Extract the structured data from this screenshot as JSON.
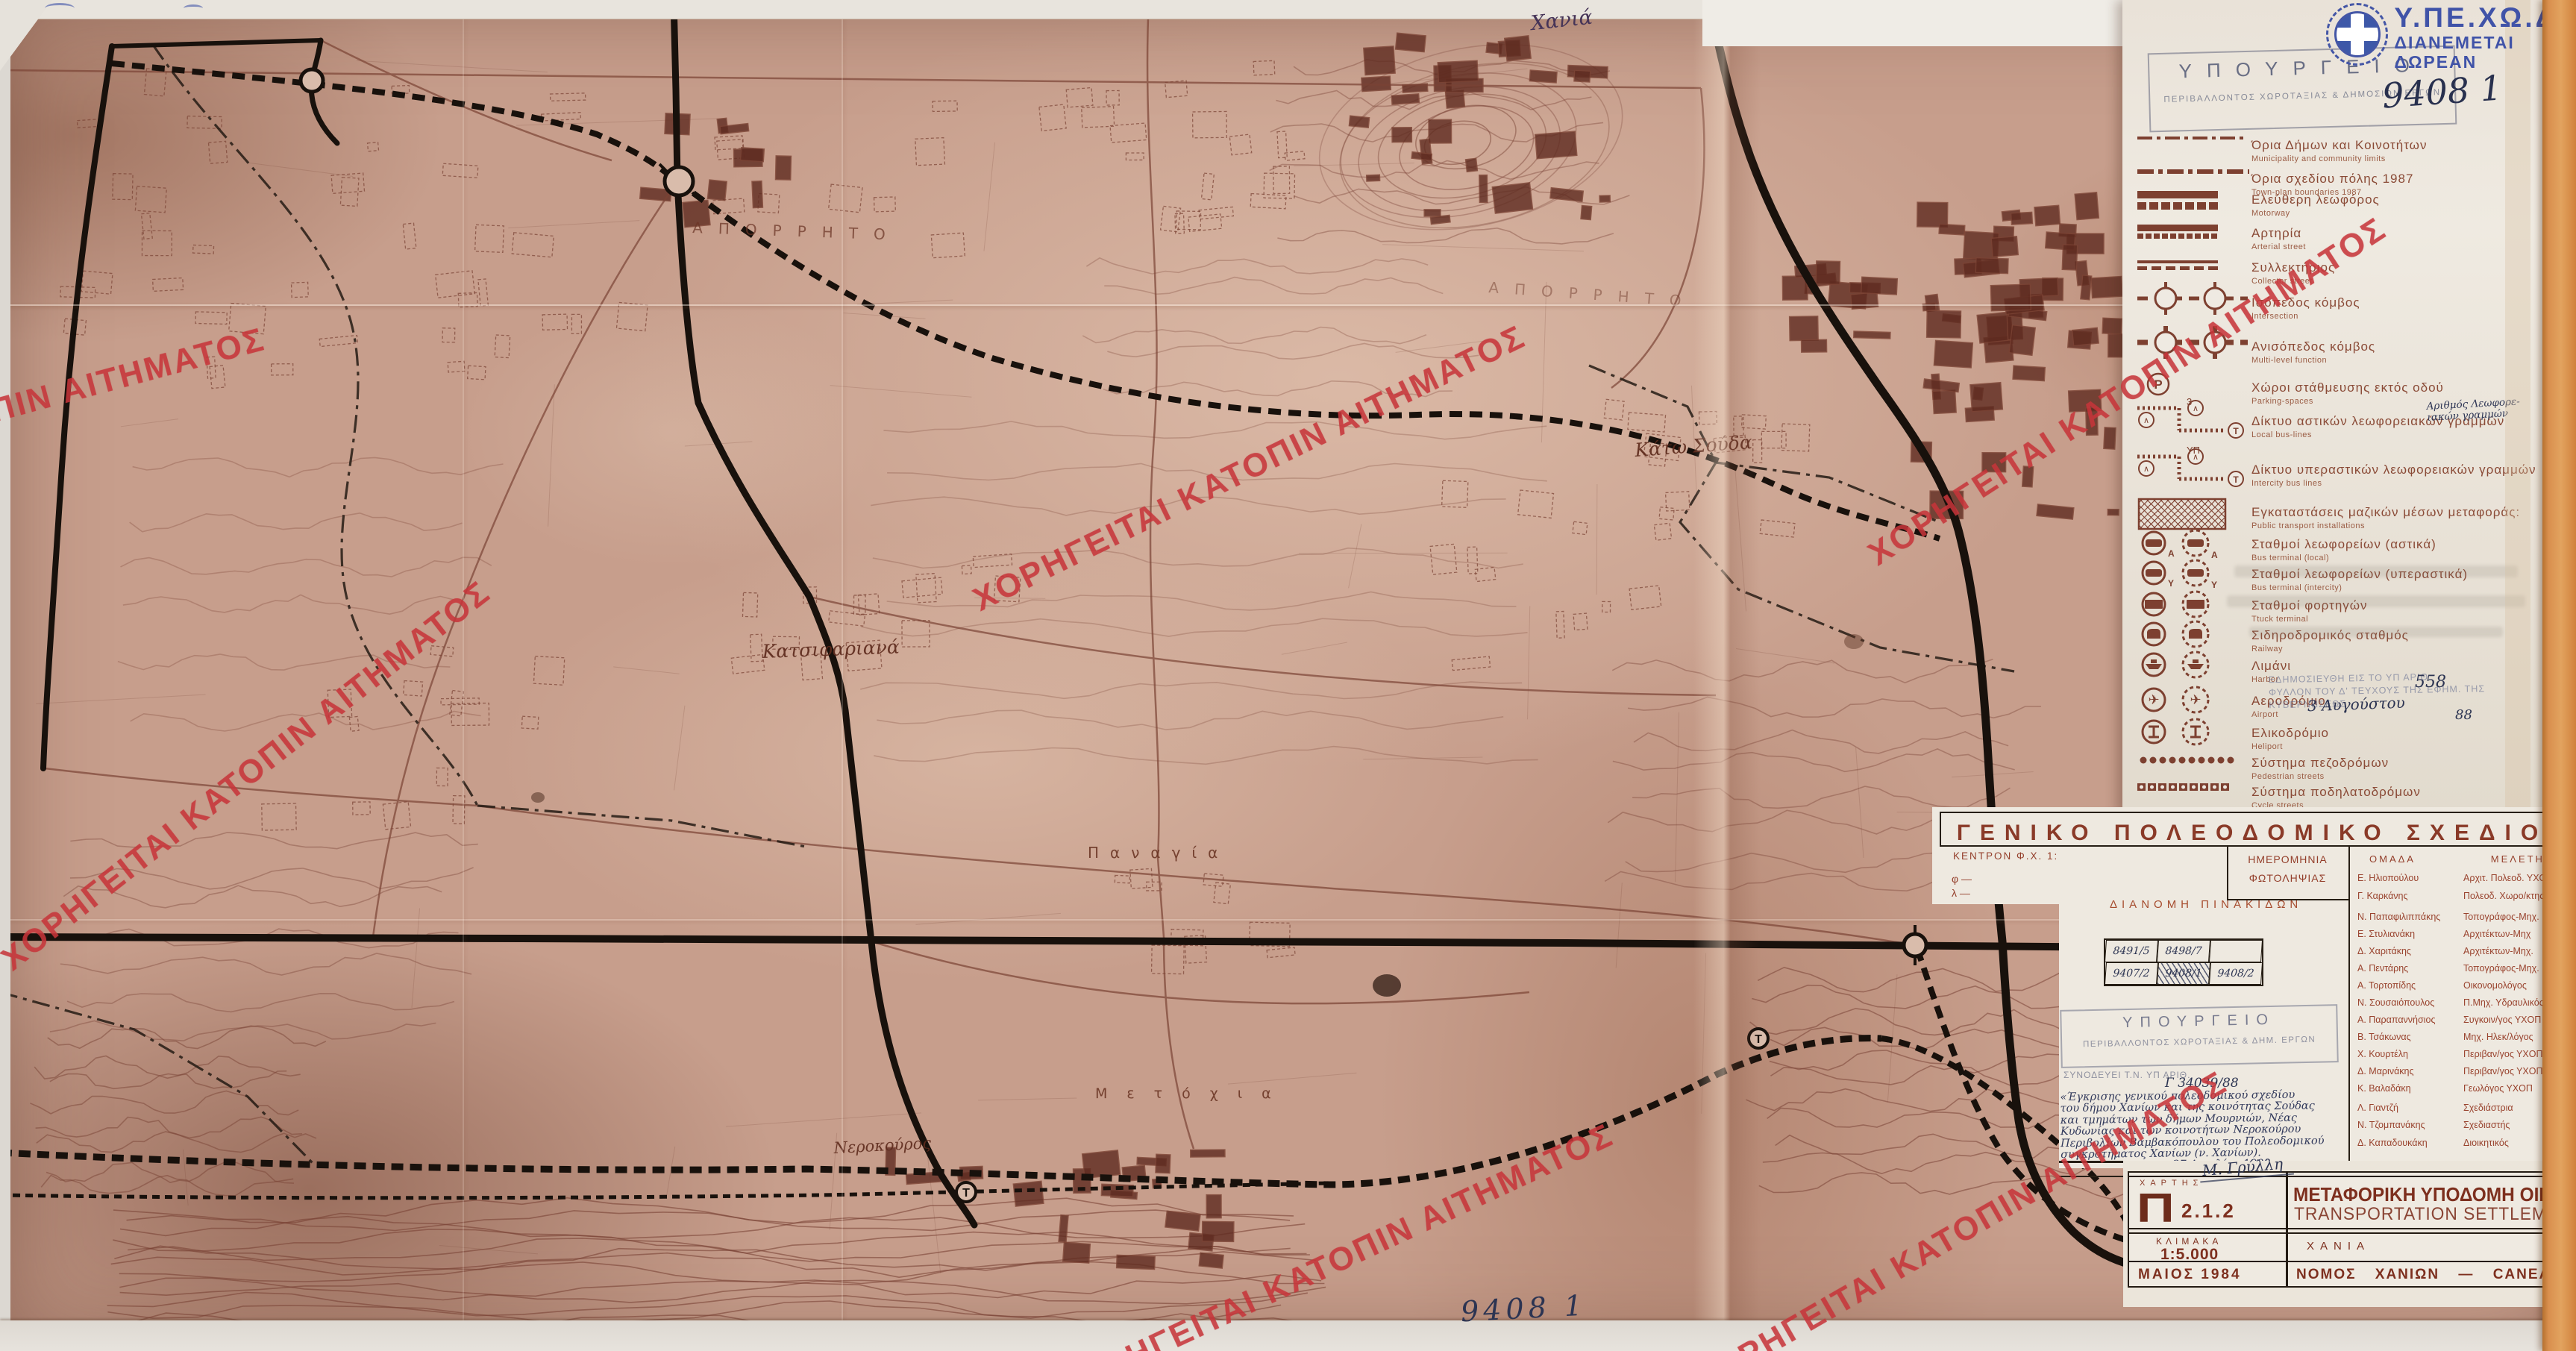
{
  "header": {
    "agency": "Υ.ΠΕ.ΧΩ.Δ.Ε.",
    "distribution_note": "ΔΙΑΝΕΜΕΤΑΙ ΔΩΡΕΑΝ",
    "handwritten_sheet_no": "9408 1",
    "handwritten_city": "Χανιά"
  },
  "watermark": {
    "text": "ΧΟΡΗΓΕΙΤΑΙ ΚΑΤΟΠΙΝ ΑΙΤΗΜΑΤΟΣ",
    "color": "#c8383e"
  },
  "legend": {
    "stamp": {
      "line1": "ΥΠΟΥΡΓΕΙΟ",
      "line2": "ΠΕΡΙΒΑΛΛΟΝΤΟΣ ΧΩΡΟΤΑΞΙΑΣ & ΔΗΜΟΣΙΩΝ ΕΡΓΩΝ"
    },
    "entries": [
      {
        "greek": "Όρια Δήμων και Κοινοτήτων",
        "english": "Municipality and community limits",
        "symbol": "boundary-municipal"
      },
      {
        "greek": "Όρια σχεδίου πόλης 1987",
        "english": "Town-plan boundaries 1987",
        "symbol": "boundary-townplan"
      },
      {
        "greek": "Ελεύθερη λεωφόρος",
        "english": "Motorway",
        "symbol": "motorway"
      },
      {
        "greek": "Αρτηρία",
        "english": "Arterial street",
        "symbol": "arterial"
      },
      {
        "greek": "Συλλεκτήριος",
        "english": "Collector street",
        "symbol": "collector"
      },
      {
        "greek": "Ισόπεδος κόμβος",
        "english": "Intersection",
        "symbol": "intersection"
      },
      {
        "greek": "Ανισόπεδος κόμβος",
        "english": "Multi-level function",
        "symbol": "interchange"
      },
      {
        "greek": "Χώροι στάθμευσης εκτός οδού",
        "english": "Parking-spaces",
        "symbol": "parking"
      },
      {
        "greek": "Δίκτυο αστικών λεωφορειακών γραμμών",
        "english": "Local bus-lines",
        "symbol": "bus-network-local"
      },
      {
        "greek": "Δίκτυο υπεραστικών λεωφορειακών γραμμών",
        "english": "Intercity bus lines",
        "symbol": "bus-network-intercity"
      },
      {
        "greek": "Εγκαταστάσεις μαζικών μέσων μεταφοράς:",
        "english": "Public transport installations",
        "symbol": "transport-installations"
      },
      {
        "greek": "Σταθμοί λεωφορείων (αστικά)",
        "english": "Bus terminal (local)",
        "symbol": "bus-terminal-local"
      },
      {
        "greek": "Σταθμοί λεωφορείων (υπεραστικά)",
        "english": "Bus terminal (intercity)",
        "symbol": "bus-terminal-intercity"
      },
      {
        "greek": "Σταθμοί φορτηγών",
        "english": "Ttuck terminal",
        "symbol": "truck-terminal"
      },
      {
        "greek": "Σιδηροδρομικός σταθμός",
        "english": "Railway",
        "symbol": "railway-station"
      },
      {
        "greek": "Λιμάνι",
        "english": "Harbor",
        "symbol": "harbor"
      },
      {
        "greek": "Αεροδρόμιο",
        "english": "Airport",
        "symbol": "airport"
      },
      {
        "greek": "Ελικοδρόμιο",
        "english": "Heliport",
        "symbol": "heliport"
      },
      {
        "greek": "Σύστημα πεζοδρόμων",
        "english": "Pedestrian streets",
        "symbol": "pedestrian-streets"
      },
      {
        "greek": "Σύστημα ποδηλατοδρόμων",
        "english": "Cycle streets",
        "symbol": "cycle-streets"
      }
    ],
    "bus_note_line1": "Αριθμός Λεωφορε-",
    "bus_note_line2": "ιακών γραμμών",
    "gazette_stamp_line1": "ΕΔΗΜΟΣΙΕΥΘΗ ΕΙΣ ΤΟ ΥΠ ΑΡΙΘ.",
    "gazette_stamp_line2": "ΦΥΛΛΟΝ ΤΟΥ Δ' ΤΕΥΧΟΥΣ ΤΗΣ ΕΦΗΜ. ΤΗΣ ΚΥΒΕΡΝΗΣΕΩΣ",
    "gazette_no": "558",
    "gazette_date": "3 Αυγούστου",
    "gazette_year": "88"
  },
  "title_block": {
    "title": "ΓΕΝΙΚΟ ΠΟΛΕΟΔΟΜΙΚΟ ΣΧΕΔΙΟ",
    "kentron_label": "ΚΕΝΤΡΟΝ Φ.Χ. 1:",
    "phi": "φ —",
    "lambda": "λ —",
    "photo_label_line1": "ΗΜΕΡΟΜΗΝΙΑ",
    "photo_label_line2": "ΦΩΤΟΛΗΨΙΑΣ",
    "team_label_1": "ΟΜΑΔΑ",
    "team_label_2": "ΜΕΛΕΤΗΣ",
    "team": [
      {
        "name": "Ε. Ηλιοπούλου",
        "role": "Αρχιτ. Πολεοδ. ΥΧΟΠ"
      },
      {
        "name": "Γ. Καρκάνης",
        "role": "Πολεοδ. Χωρο/κτης"
      },
      {
        "name": "Ν. Παπαφιλιππάκης",
        "role": "Τοπογράφος-Μηχ."
      },
      {
        "name": "Ε. Στυλιανάκη",
        "role": "Αρχιτέκτων-Μηχ"
      },
      {
        "name": "Δ. Χαριτάκης",
        "role": "Αρχιτέκτων-Μηχ."
      },
      {
        "name": "Α. Πεντάρης",
        "role": "Τοπογράφος-Μηχ."
      },
      {
        "name": "Α. Τορτοπίδης",
        "role": "Οικονομολόγος"
      },
      {
        "name": "Ν. Σουσαιόπουλος",
        "role": "Π.Μηχ. Υδραυλικός"
      },
      {
        "name": "Α. Παραπαννήσιος",
        "role": "Συγκοιν/γος ΥΧΟΠ"
      },
      {
        "name": "Β. Τσάκωνας",
        "role": "Μηχ. Ηλεκ/λόγος"
      },
      {
        "name": "Χ. Κουρτέλη",
        "role": "Περιβαν/γος ΥΧΟΠ"
      },
      {
        "name": "Δ. Μαρινάκης",
        "role": "Περιβαν/γος ΥΧΟΠ"
      },
      {
        "name": "Κ. Βαλαδάκη",
        "role": "Γεωλόγος ΥΧΟΠ"
      },
      {
        "name": "Λ. Γιαντζή",
        "role": "Σχεδιάστρια"
      },
      {
        "name": "Ν. Τζομπανάκης",
        "role": "Σχεδιαστής"
      },
      {
        "name": "Δ. Καπαδουκάκη",
        "role": "Διοικητικός"
      }
    ],
    "distribution_label": "ΔΙΑΝΟΜΗ ΠΙΝΑΚΙΔΩΝ",
    "sheet_grid": [
      [
        "8491/5",
        "8498/7",
        ""
      ],
      [
        "9407/2",
        "9408/1",
        "9408/2"
      ]
    ],
    "stamp2_line1": "ΥΠΟΥΡΓΕΙΟ",
    "stamp2_line2": "ΠΕΡΙΒΑΛΛΟΝΤΟΣ ΧΩΡΟΤΑΞΙΑΣ & ΔΗΜ. ΕΡΓΩΝ",
    "stamp2_line3": "ΣΥΝΟΔΕΥΕΙ Τ.Ν. ΥΠ ΑΡΙΘ.",
    "approval_no": "Γ 34039/88",
    "approval_note_lines": [
      "«Έγκρισης γενικού πολεοδομικού σχεδίου",
      "του δήμου Χανίων και της κοινότητας Σούδας",
      "και τμημάτων των δήμων Μουρνιών, Νέας",
      "Κυδωνίας και των κοινοτήτων Νεροκούρου",
      "Περιβολίων Βαμβακόπουλου του Πολεοδομικού",
      "συγκροτήματος Χανίων (ν. Χανίων).",
      "27 Απριλίου 1988",
      "Η Διευθύντρια"
    ],
    "signature": "Μ. Γρύλλη"
  },
  "map_card": {
    "chartis_label": "ΧΑΡΤΗΣ",
    "code_letter": "Π",
    "code_number": "2.1.2",
    "title_gr": "ΜΕΤΑΦΟΡΙΚΗ ΥΠΟΔΟΜΗ ΟΙΚΙΣΜΟΣ",
    "title_en": "TRANSPORTATION SETTLEMENT",
    "scale_label": "ΚΛΙΜΑΚΑ",
    "scale": "1:5.000",
    "city": "ΧΑΝΙΑ",
    "date": "ΜΑΙΟΣ 1984",
    "prefecture": "ΝΟΜΟΣ ΧΑΝΙΩΝ — CANEA"
  },
  "map_labels": {
    "katsifariana": "Κατσιφαριανά",
    "panagia": "Παναγία",
    "metochia": "Μετόχια",
    "nerokouros": "Νεροκούρος",
    "kato_souda": "Κάτω Σούδα",
    "aporrito": "ΑΠΟΡΡΗΤΟ",
    "bottom_sheet_no": "9408 1"
  }
}
